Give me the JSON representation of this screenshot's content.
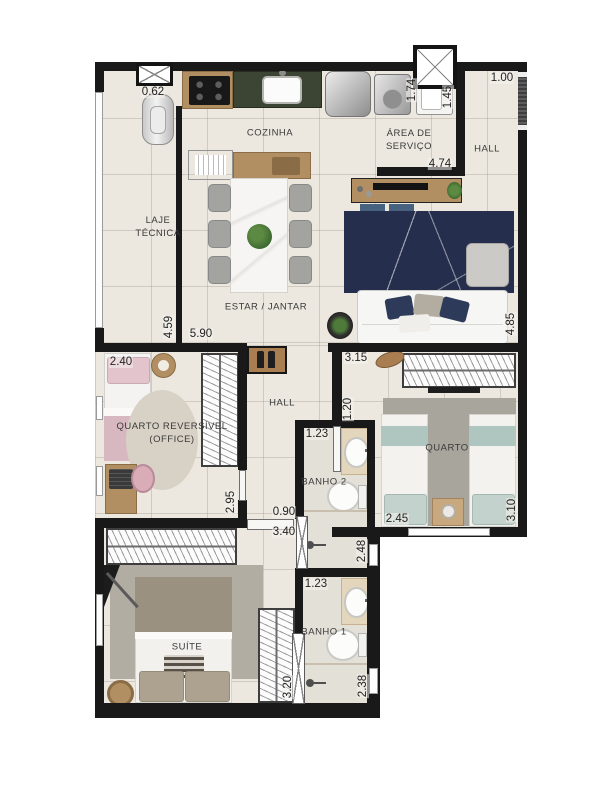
{
  "plan_labels": {
    "cozinha": "COZINHA",
    "area_servico_l1": "ÁREA DE",
    "area_servico_l2": "SERVIÇO",
    "hall_top": "HALL",
    "laje_l1": "LAJE",
    "laje_l2": "TÉCNICA",
    "estar_jantar": "ESTAR / JANTAR",
    "office_l1": "QUARTO REVERSÍVEL",
    "office_l2": "(OFFICE)",
    "hall_mid": "HALL",
    "quarto": "QUARTO",
    "banho2": "BANHO 2",
    "banho1": "BANHO 1",
    "suite": "SUÍTE"
  },
  "dimensions": {
    "laje_shaft_w": "0.62",
    "hall_entry_w": "1.00",
    "servico_d1": "1.74",
    "servico_d2": "1.45",
    "servico_len": "4.74",
    "estar_depth": "4.59",
    "estar_len": "5.90",
    "estar_right": "4.85",
    "quarto_top_w": "3.15",
    "office_w": "2.40",
    "quarto_entry_d": "1.20",
    "banho2_w": "1.23",
    "office_d": "2.95",
    "hall_w": "0.90",
    "suite_w": "3.40",
    "banho2_d": "2.48",
    "quarto_w": "2.45",
    "quarto_d": "3.10",
    "banho1_w": "1.23",
    "suite_d": "3.20",
    "banho1_d": "2.38"
  },
  "colors": {
    "wall": "#191919",
    "floor": "#ece8df",
    "wood": "#b28e63",
    "granite_counter": "#3c4434",
    "rug_navy": "#252e4c",
    "rug_gray": "#a8a69c",
    "accent_pink": "#e3c4cc",
    "accent_teal": "#aec5c0"
  }
}
